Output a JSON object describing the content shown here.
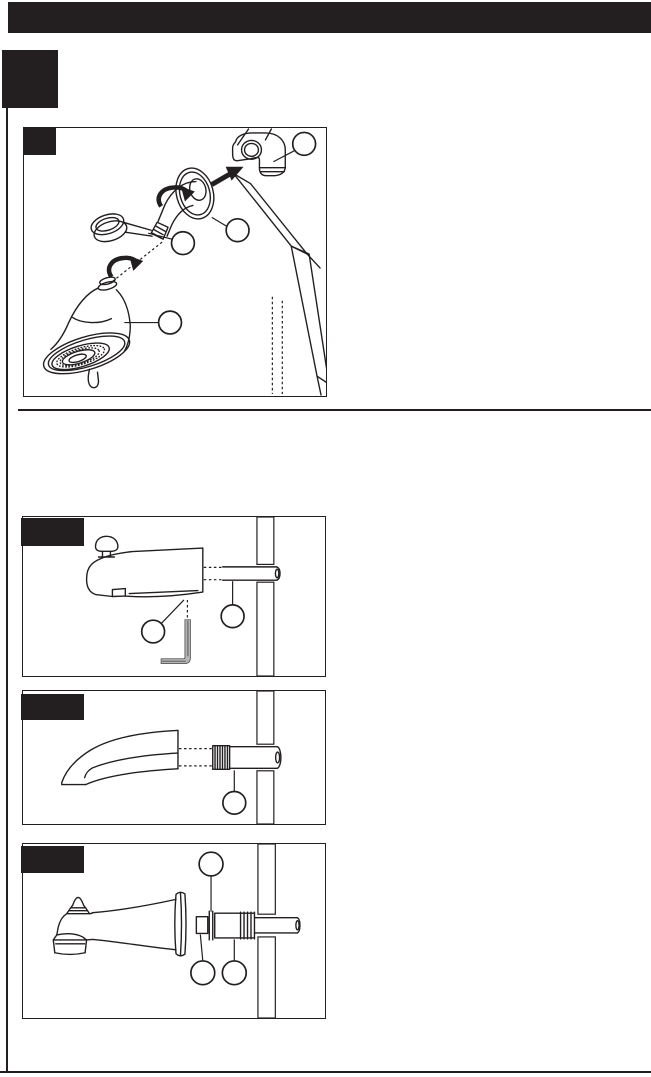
{
  "palette": {
    "paper": "#ffffff",
    "ink": "#231f20",
    "metal_gray": "#b5b5b5",
    "thread_gray": "#8e8e8e"
  },
  "top_banner": {
    "text": ""
  },
  "step_box": {
    "text": ""
  },
  "figures": [
    {
      "id": "shower-head-arm-install",
      "label_text": "",
      "callout_count": 4,
      "depicts": "shower head, shower arm with flange, pipe elbow on wall stud, rotation arrows"
    },
    {
      "id": "tub-spout-set-screw",
      "label_text": "",
      "callout_count": 2,
      "depicts": "diverter tub spout, allen wrench, supply pipe through hatched wall"
    },
    {
      "id": "tub-spout-threaded",
      "label_text": "",
      "callout_count": 1,
      "depicts": "tub spout and threaded pipe nipple through hatched wall"
    },
    {
      "id": "tub-spout-slip-fit",
      "label_text": "",
      "callout_count": 3,
      "depicts": "diverter tub spout, slip-fit adapter with o-rings, copper pipe through hatched wall"
    }
  ]
}
